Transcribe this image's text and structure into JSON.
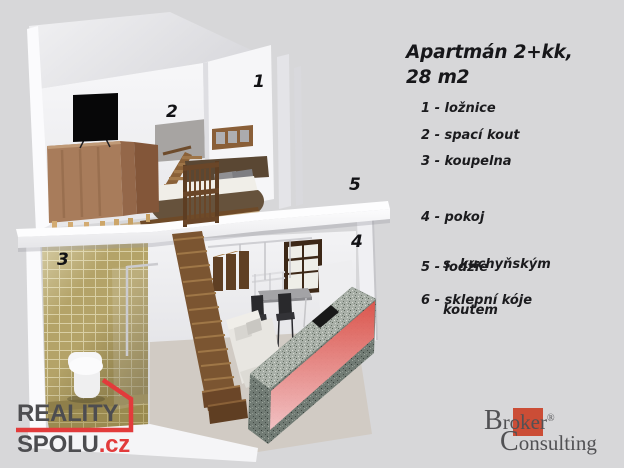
{
  "page": {
    "background_color": "#d7d7d9"
  },
  "info_panel": {
    "title_line1": "Apartmán 2+kk,",
    "title_line2": "28 m2",
    "legend": [
      {
        "text": "1 - ložnice"
      },
      {
        "text": "2 - spací kout"
      },
      {
        "text": "3 - koupelna"
      },
      {
        "text": "4 - pokoj",
        "line2": "s  kuchyňským",
        "line3": "koutem"
      },
      {
        "text": "5 - lodžie"
      },
      {
        "text": "6 - sklepní kóje"
      }
    ]
  },
  "render": {
    "numbers": [
      "1",
      "2",
      "3",
      "4",
      "5"
    ]
  },
  "logos": {
    "reality_spolu": {
      "word1": "REALITY",
      "word2": "SPOLU",
      "tld": ".cz",
      "accent_color": "#e23b3b",
      "text_color": "#4d4d50"
    },
    "broker_consulting": {
      "word1_initial": "B",
      "word1_rest": "roker",
      "trademark": "®",
      "word2_initial": "C",
      "word2_rest": "onsulting",
      "square_color": "#cb4d36",
      "text_color": "#515154"
    }
  }
}
